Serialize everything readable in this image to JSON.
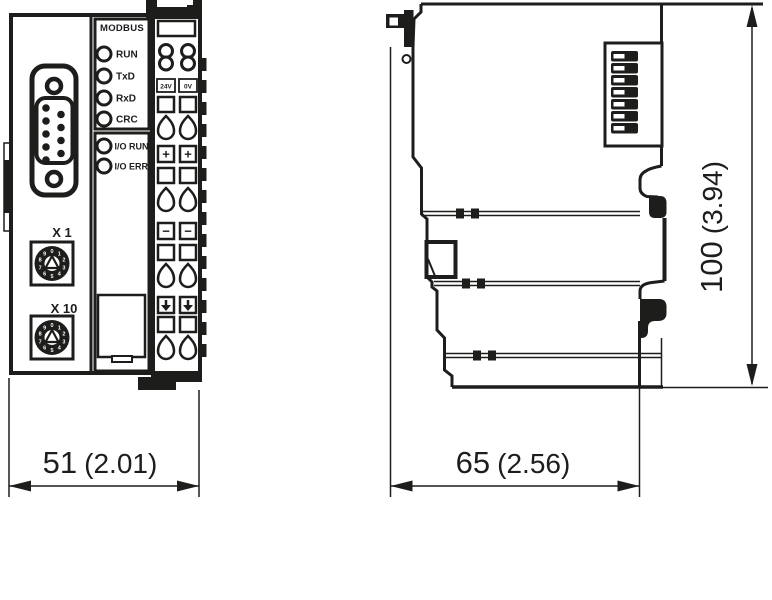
{
  "drawing_title": "fieldbus-coupler-dimension-drawing",
  "front_view": {
    "modbus_label": "MODBUS",
    "status_leds": [
      "RUN",
      "TxD",
      "RxD",
      "CRC"
    ],
    "io_leds": [
      "I/O RUN",
      "I/O ERR"
    ],
    "rotary_switches": [
      {
        "label": "X 1"
      },
      {
        "label": "X 10"
      }
    ],
    "rotary_digits": [
      "0",
      "1",
      "2",
      "3",
      "4",
      "5",
      "6",
      "7",
      "8",
      "9"
    ],
    "power_terminal_labels": [
      "24V",
      "0V"
    ],
    "terminal_symbols": {
      "plus": "+",
      "minus": "−",
      "pe": "down-arrow"
    }
  },
  "side_view": {
    "dip_switch_count": 7
  },
  "dimensions": {
    "width": {
      "mm": "51",
      "inch": "(2.01)"
    },
    "depth": {
      "mm": "65",
      "inch": "(2.56)"
    },
    "height": {
      "mm": "100",
      "inch": "(3.94)"
    }
  },
  "colors": {
    "ink": "#1d1d1b",
    "background": "#ffffff"
  }
}
